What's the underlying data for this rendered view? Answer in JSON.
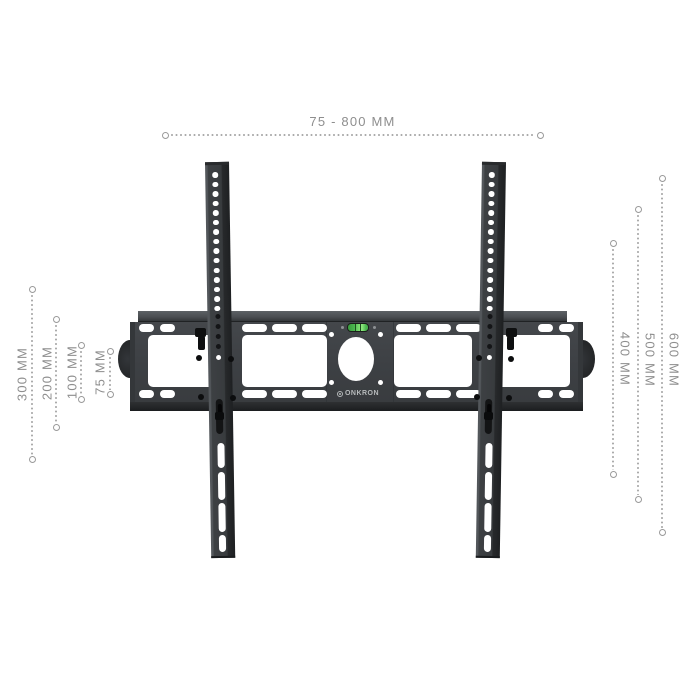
{
  "product": {
    "brand": "ONKRON"
  },
  "dimensions": {
    "top": {
      "label": "75 - 800 MM"
    },
    "right": [
      {
        "label": "400 MM"
      },
      {
        "label": "500 MM"
      },
      {
        "label": "600 MM"
      }
    ],
    "left": [
      {
        "label": "300 MM"
      },
      {
        "label": "200 MM"
      },
      {
        "label": "100 MM"
      },
      {
        "label": "75 MM"
      }
    ]
  },
  "colors": {
    "bracket_dark": "#3d4043",
    "level_green": "#49b44d",
    "dimension_gray": "#8e8e8e",
    "background": "#ffffff"
  }
}
